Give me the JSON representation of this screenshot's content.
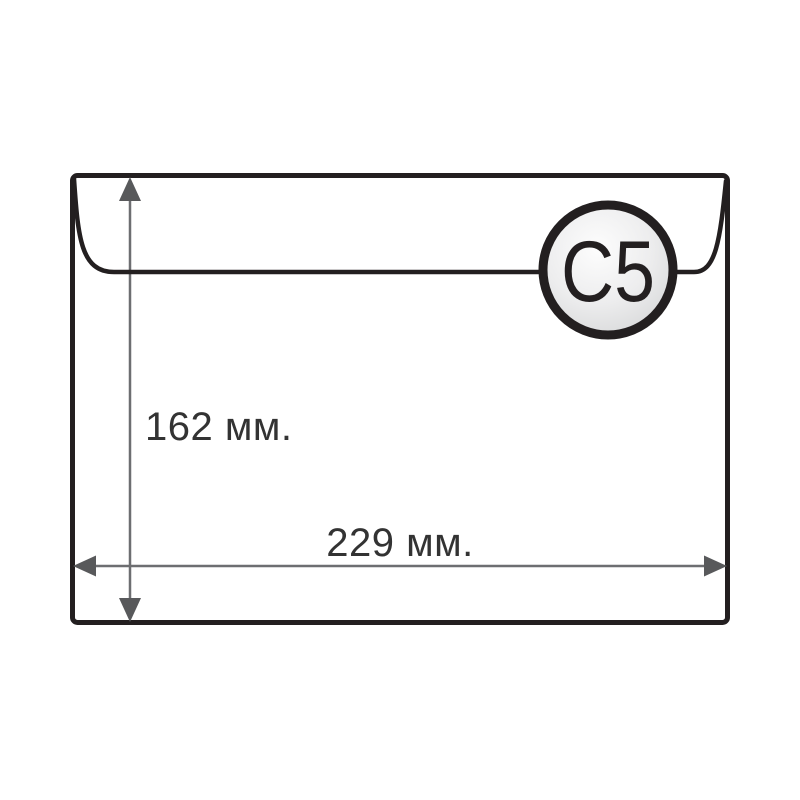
{
  "diagram": {
    "type": "envelope-size-diagram",
    "badge_label": "C5",
    "height_label": "162 мм.",
    "width_label": "229 мм."
  },
  "colors": {
    "background": "#ffffff",
    "envelope_fill": "#ffffff",
    "envelope_outline": "#231f20",
    "arrow_line": "#6d6e71",
    "arrow_head": "#58595b",
    "label_text": "#333333",
    "badge_outline": "#231f20",
    "badge_gradient_start": "#fdfdfd",
    "badge_gradient_end": "#d6d7d8",
    "badge_text": "#231f20"
  }
}
